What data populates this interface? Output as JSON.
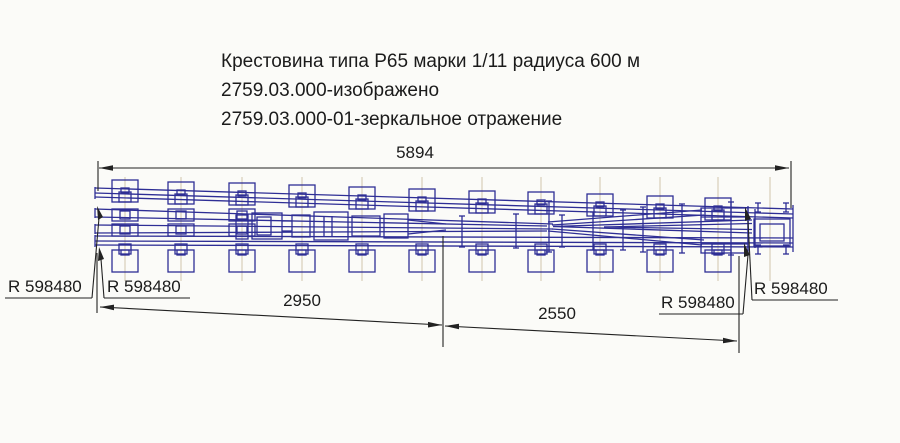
{
  "title": {
    "line1": "Крестовина типа Р65 марки 1/11 радиуса 600 м",
    "line2": "2759.03.000-изображено",
    "line3": "2759.03.000-01-зеркальное отражение"
  },
  "dimensions": {
    "overall": "5894",
    "left_span": "2950",
    "right_span": "2550"
  },
  "radius_labels": [
    {
      "label": "R 598480"
    },
    {
      "label": "R 598480"
    },
    {
      "label": "R 598480"
    },
    {
      "label": "R 598480"
    }
  ],
  "colors": {
    "drawing_blue": "#2e2e95",
    "dimension_black": "#222222",
    "sleeper_centerline_tan": "#cdc3a8",
    "background": "#fbfbf8"
  }
}
